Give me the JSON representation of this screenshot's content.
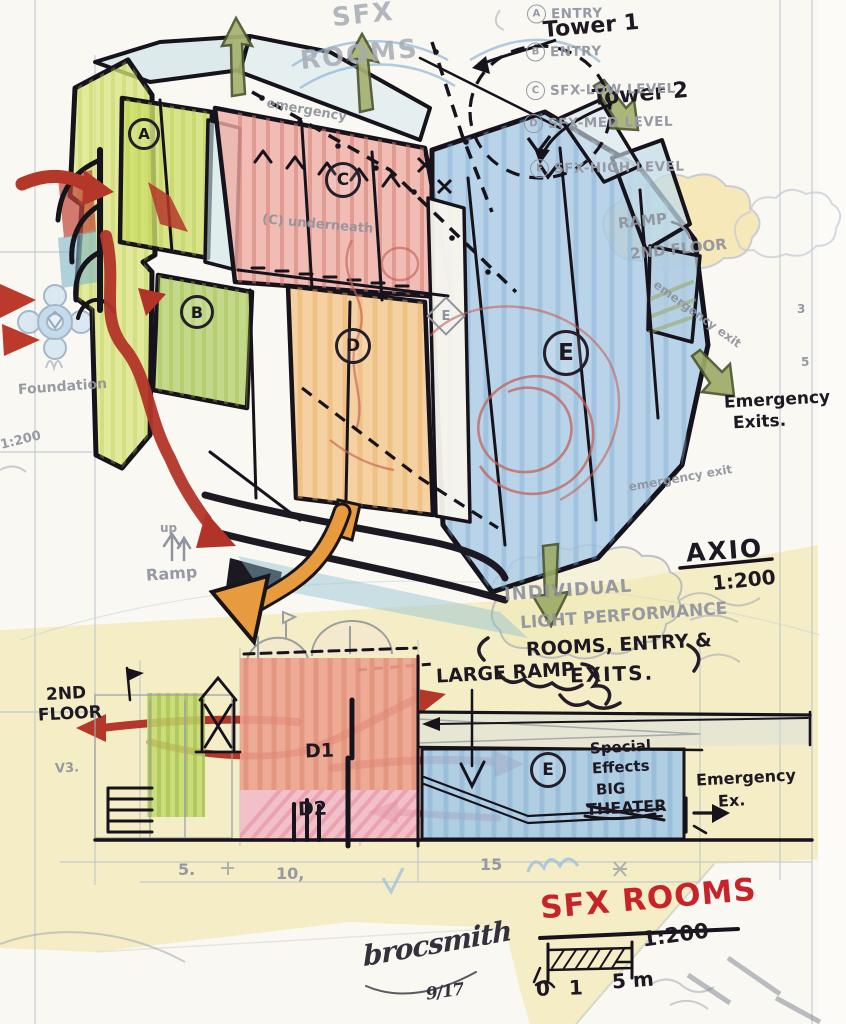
{
  "drawing": {
    "pencil_title": {
      "line1": "SFX",
      "line2": "ROOMS"
    },
    "tower_labels": {
      "tower1": "Tower 1",
      "tower2": "Tower 2"
    },
    "legend": {
      "items": [
        {
          "key": "A",
          "label": "ENTRY"
        },
        {
          "key": "B",
          "label": "ENTRY"
        },
        {
          "key": "C",
          "label": "SFX-LOW LEVEL"
        },
        {
          "key": "D",
          "label": "SFX-MED LEVEL"
        },
        {
          "key": "E",
          "label": "SFX-HIGH LEVEL"
        }
      ]
    },
    "zone_markers": {
      "a": "A",
      "b": "B",
      "c": "C",
      "d": "D",
      "e": "E",
      "e_pencil": "E"
    },
    "notes": {
      "underneath": "(C) underneath",
      "emergency_pencil_top": "emergency",
      "emergency_pencil_right": "emergency exit",
      "emergency_pencil_lower": "emergency exit",
      "emergency_exits_line1": "Emergency",
      "emergency_exits_line2": "Exits.",
      "axio_title": "AXIO",
      "axio_scale": "1:200",
      "cloud_pencil_line1": "INDIVIDUAL",
      "cloud_pencil_line2": "LIGHT PERFORMANCE",
      "cloud_marker_line1": "ROOMS, ENTRY &",
      "cloud_marker_line2": "EXITS.",
      "ramp_cloud_line1": "RAMP",
      "ramp_cloud_line2": "2ND FLOOR",
      "up_ramp_line1": "up",
      "up_ramp_line2": "Ramp",
      "foundation": "Foundation",
      "left_scale": "1:200",
      "elevation_mark": "V3."
    }
  },
  "section": {
    "second_floor_line1": "2ND",
    "second_floor_line2": "FLOOR",
    "large_ramp": "LARGE RAMP",
    "room_d1": "D1",
    "room_d2": "D2",
    "theater_letter": "E",
    "theater_line1": "Special",
    "theater_line2": "Effects",
    "theater_line3": "BIG",
    "theater_line4": "THEATER",
    "emergency_line1": "Emergency",
    "emergency_line2": "Ex.",
    "ticks": [
      "5.",
      "10,",
      "15"
    ]
  },
  "titleblock": {
    "title": "SFX ROOMS",
    "scale": "1:200",
    "scalebar_zero": "0 1",
    "scalebar_five": "5 m",
    "signature": "brocsmith",
    "date": "9/17"
  },
  "margin": {
    "num3": "3",
    "num5": "5"
  },
  "colors": {
    "red_marker": "#b5372a",
    "red_text": "#c9232a",
    "black_marker": "#1d1822",
    "pencil_gray": "#8f939d",
    "zone_lime": "#cfdf6b",
    "zone_green": "#b9d477",
    "zone_pink": "#efaca4",
    "zone_orange": "#f4c78c",
    "zone_blue": "#a9cbe6",
    "olive_arrow": "#a4b170",
    "orange_arrow": "#e79b3e",
    "trace_yellow": "#f1e9b4"
  }
}
